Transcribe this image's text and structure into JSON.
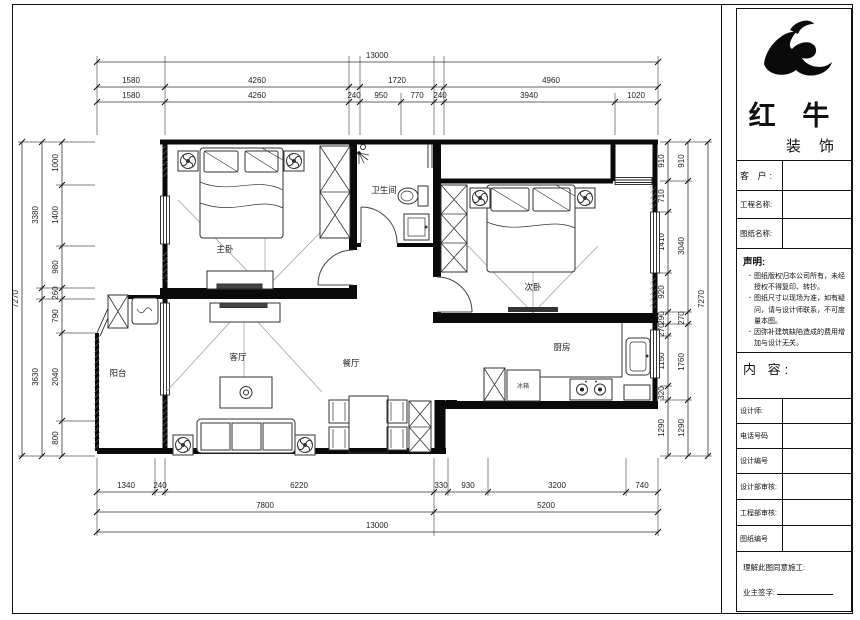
{
  "title_block": {
    "brand": {
      "name": "红 牛",
      "sub": "装 饰"
    },
    "fields": {
      "customer": "客 户:",
      "project": "工程名称:",
      "drawing": "图纸名称:"
    },
    "statement": {
      "title": "声明:",
      "items": [
        "图纸版权归本公司所有，未经授权不得复印、转抄。",
        "图纸尺寸以现场为准，如有疑问，请与设计师联系，不可度量本图。",
        "因弥补建筑缺陷造成的费用增加与设计无关。"
      ]
    },
    "content_label": "内 容:",
    "rows": [
      "设计师:",
      "电话号码",
      "设计编号",
      "设计部审核:",
      "工程部审核:",
      "图纸编号"
    ],
    "footer": {
      "line1": "理解此图同意施工:",
      "sign": "业主签字:"
    }
  },
  "rooms": {
    "master": "主卧",
    "bath": "卫生间",
    "second": "次卧",
    "living": "客厅",
    "dining": "餐厅",
    "kitchen": "厨房",
    "balcony": "阳台",
    "fridge": "冰箱"
  },
  "dims": {
    "top1": [
      "13000"
    ],
    "top2": [
      "1580",
      "4260",
      "1720",
      "4960"
    ],
    "top3": [
      "1580",
      "4260",
      "240",
      "950",
      "770",
      "240",
      "3940",
      "1020"
    ],
    "bottom1": [
      "1340",
      "240",
      "6220",
      "330",
      "930",
      "3200",
      "740"
    ],
    "bottom2": [
      "7800",
      "5200"
    ],
    "bottom3": [
      "13000"
    ],
    "left_outer": "7270",
    "left_mid": [
      "3380",
      "3630"
    ],
    "left_inner": [
      "1000",
      "1400",
      "980",
      "260",
      "790",
      "2040",
      "800"
    ],
    "right_inner": [
      "910",
      "710",
      "1410",
      "920",
      "290",
      "270",
      "1150",
      "320",
      "1290"
    ],
    "right_mid": [
      "910",
      "3040",
      "270",
      "1760",
      "1290"
    ],
    "right_outer": "7270"
  }
}
